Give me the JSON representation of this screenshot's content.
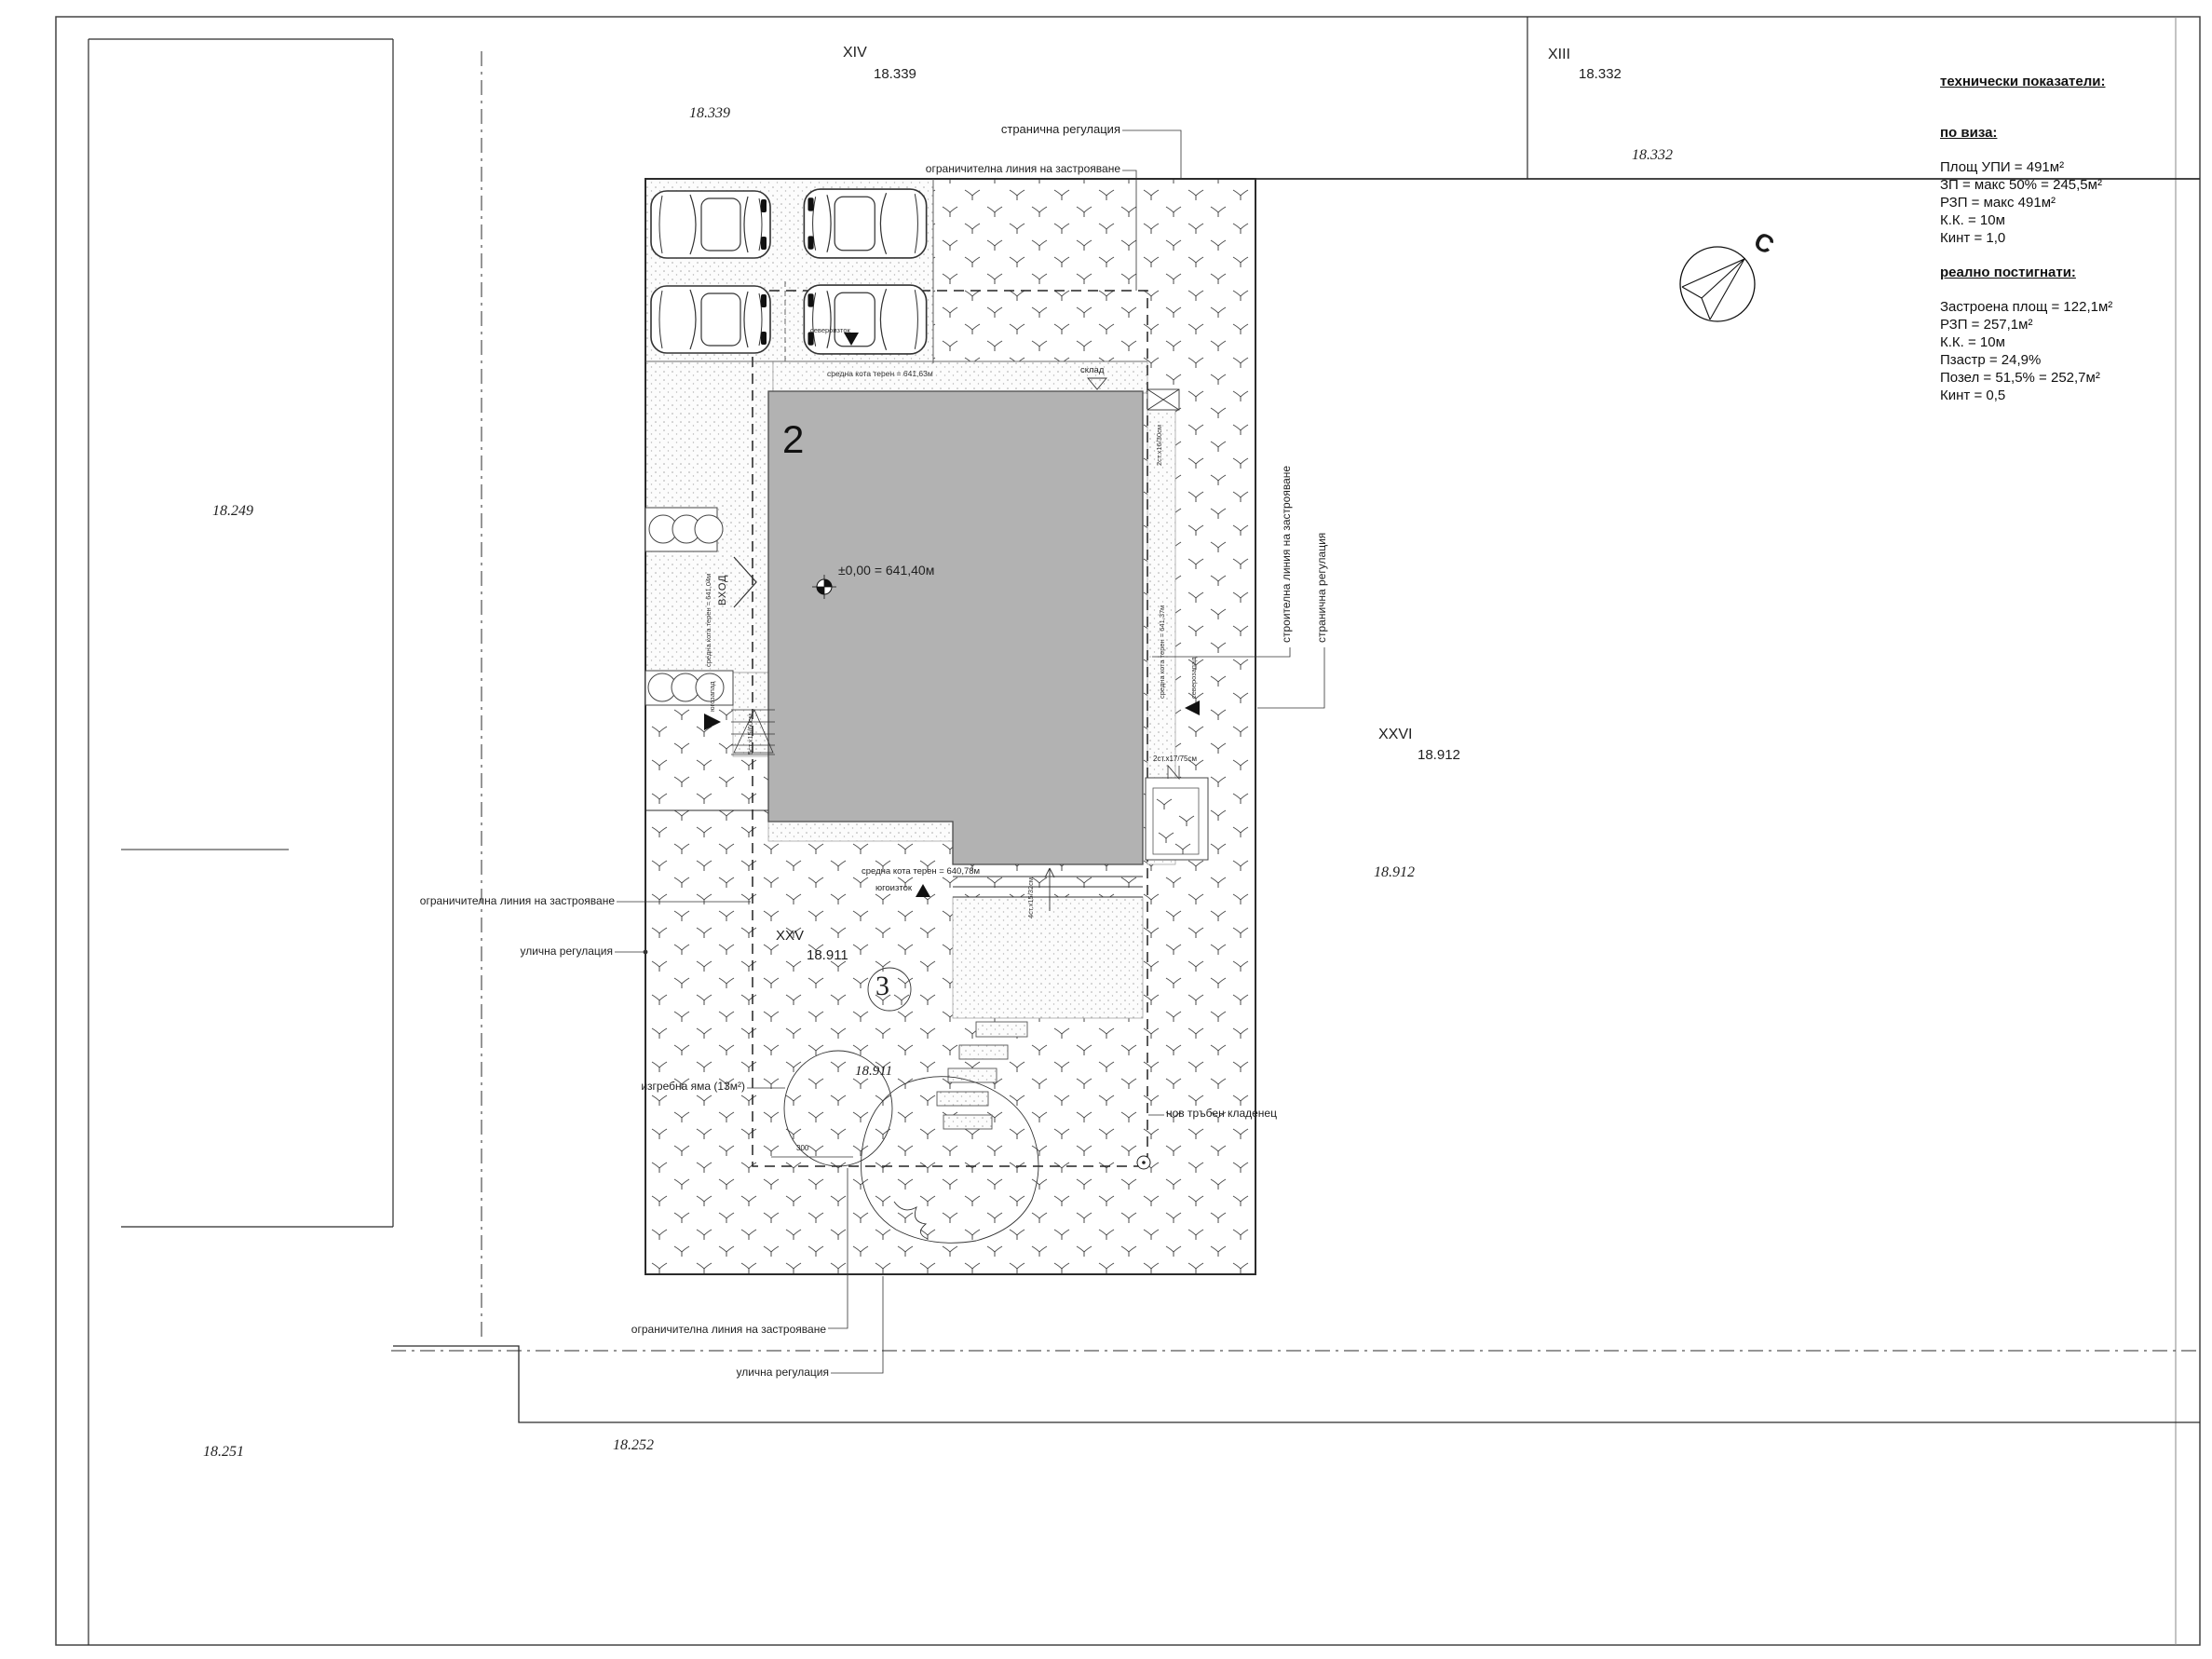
{
  "plots": {
    "xiv": {
      "id": "XIV",
      "value": "18.339",
      "corner": "18.339"
    },
    "xiii": {
      "id": "XIII",
      "value": "18.332",
      "corner": "18.332"
    },
    "xxvi": {
      "id": "XXVI",
      "value": "18.912",
      "corner": "18.912"
    },
    "xxv": {
      "id": "XXV",
      "value": "18.911",
      "corner": "18.911"
    },
    "west_corner": "18.249",
    "southwest_corner": "18.251",
    "south_corner": "18.252"
  },
  "regulation": {
    "limit_line": "ограничителна линия на застрояване",
    "street_reg": "улична регулация",
    "side_reg": "странична регулация",
    "build_line": "строителна линия на застрояване"
  },
  "site": {
    "building_number": "2",
    "zero_level": "±0,00 = 641,40м",
    "entrance": "ВХОД",
    "storage": "склад",
    "tree_tag": "3",
    "well": "нов тръбен кладенец",
    "cesspit": "изгребна яма (13м²)",
    "dim_300": "300"
  },
  "terrain": {
    "north": "средна кота терен = 641,63м",
    "west": "средна кота терен = 641,04м",
    "east": "средна кота терен = 641,37м",
    "south": "средна кота терен = 640,78м"
  },
  "directions": {
    "sw": "югозапад",
    "ne": "североизток",
    "nw": "северозапад",
    "se": "югоизток"
  },
  "stairs": {
    "west": "5ст.х15/60см",
    "northeast": "2ст.х16/30см",
    "south": "4ст.х15/32см",
    "southeast": "2ст.х17/75см"
  },
  "compass": {
    "north_letter": "С"
  },
  "tech": {
    "title": "технически показатели:",
    "per_visa": {
      "heading": "по виза:",
      "lines": [
        "Площ УПИ = 491м²",
        "ЗП = макс 50% = 245,5м²",
        "РЗП = макс 491м²",
        "К.К. = 10м",
        "Кинт = 1,0"
      ]
    },
    "achieved": {
      "heading": "реално постигнати:",
      "lines": [
        "Застроена площ = 122,1м²",
        "РЗП = 257,1м²",
        "К.К. = 10м",
        "Пзастр = 24,9%",
        "Позел = 51,5% = 252,7м²",
        "Кинт = 0,5"
      ]
    }
  }
}
